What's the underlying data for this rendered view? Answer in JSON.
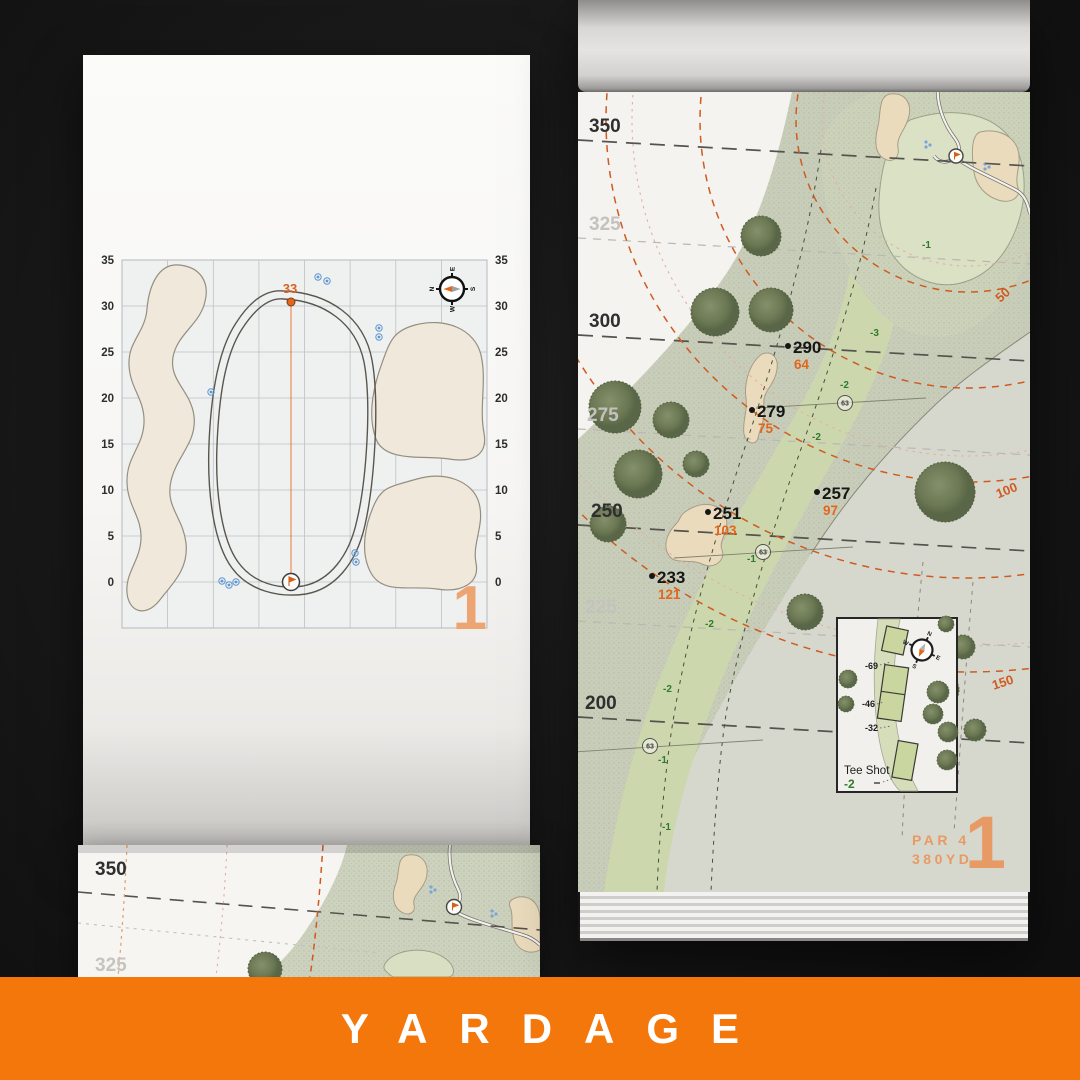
{
  "banner": {
    "title": "YARDAGE"
  },
  "colors": {
    "banner_orange": "#F4770B",
    "accent_orange": "#E2661C",
    "numeral_orange": "#E89A64"
  },
  "compass": {
    "n": "N",
    "e": "E",
    "s": "S",
    "w": "W"
  },
  "left_page": {
    "hole_number": "1",
    "pin_distance": "33",
    "axis_labels": [
      "35",
      "30",
      "25",
      "20",
      "15",
      "10",
      "5",
      "0"
    ]
  },
  "right_page": {
    "hole_number": "1",
    "par": "PAR 4",
    "total_yardage": "380YD",
    "distance_lines": [
      "350",
      "325",
      "300",
      "275",
      "250",
      "225",
      "200"
    ],
    "arc_labels": [
      "50",
      "100",
      "150"
    ],
    "points": [
      {
        "carry": "290",
        "to_green": "64"
      },
      {
        "carry": "279",
        "to_green": "75"
      },
      {
        "carry": "257",
        "to_green": "97"
      },
      {
        "carry": "251",
        "to_green": "103"
      },
      {
        "carry": "233",
        "to_green": "121"
      }
    ],
    "sprinkler_heads": [
      "63",
      "63",
      "63"
    ],
    "slopes": [
      "-1",
      "-3",
      "-2",
      "-2",
      "-1",
      "-2",
      "-2",
      "-1",
      "-1"
    ],
    "tee_inset": {
      "title": "Tee Shot",
      "slope": "-2",
      "tee_distances": [
        "-69",
        "-46",
        "-32"
      ]
    }
  },
  "bottom_page": {
    "distance_lines": [
      "350",
      "325"
    ]
  }
}
